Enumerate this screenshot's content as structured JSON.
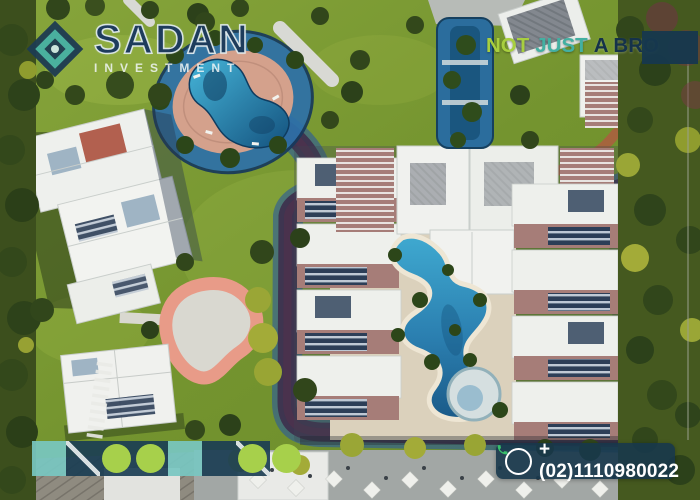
{
  "overlay": {
    "logo": {
      "icon": "diamond-logo-icon",
      "brand": "SADAN",
      "subtitle": "INVESTMENT"
    },
    "tagline": {
      "word1": "NOT",
      "word2": "JUST",
      "word3": "A BRO"
    },
    "contact": {
      "icon": "phone-icon",
      "phone": "+(02)1110980022"
    }
  },
  "deco_band": {
    "tiles": [
      "teal",
      "navy-diag",
      "navy-circle",
      "navy-circle",
      "teal",
      "navy",
      "navy-diag-circle",
      "circle"
    ]
  },
  "scene": {
    "alt": "Aerial drone view of a residential compound with white villas, lagoon swimming pools, a central apartment block around a meandering pool, roads and landscaped gardens"
  },
  "colors": {
    "brand_navy": "#1d3b52",
    "brand_teal": "#47b1a4",
    "lime_green": "#a7d04b",
    "tagline_green": "#a8cf3f",
    "tagline_teal": "#43b0a2",
    "phone_green": "#39c06b",
    "pool_blue": "#2d8ec2",
    "deck_pink": "#d4a18c",
    "loop_pink": "#e89b88",
    "grass_green": "#74942f",
    "sand": "#dbd1bc",
    "building_mauve": "#a67d78"
  }
}
